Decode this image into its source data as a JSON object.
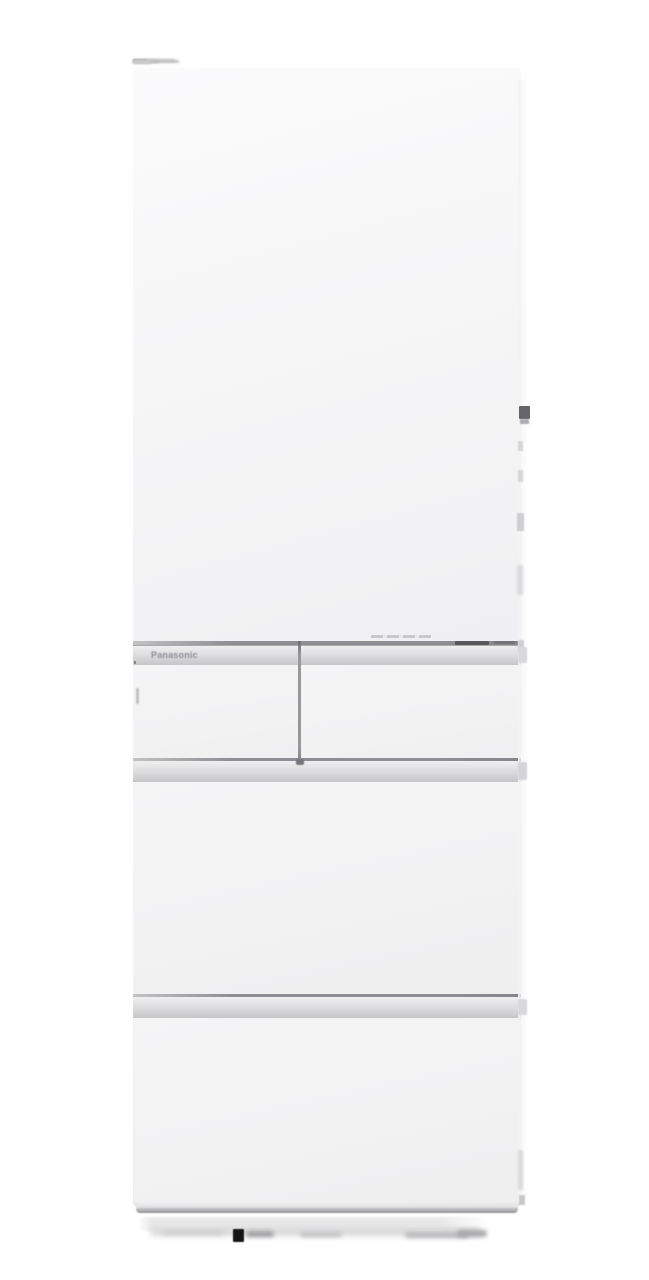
{
  "scene": {
    "subject": "white multi-door refrigerator, front view",
    "background": "plain white studio backdrop"
  },
  "branding": {
    "logo_text": "Panasonic"
  },
  "refrigerator": {
    "door_count_visible": 5,
    "parts": [
      {
        "name": "upper-door"
      },
      {
        "name": "middle-left-door"
      },
      {
        "name": "middle-right-door"
      },
      {
        "name": "middle-drawer"
      },
      {
        "name": "bottom-drawer"
      }
    ],
    "handle_style": "recessed horizontal pull bars"
  },
  "colors": {
    "background": "#ffffff",
    "door_light": "#fbfbfc",
    "door_mid": "#f6f6f7",
    "door_dark": "#f0f0f2",
    "handle_light": "#efeff0",
    "handle_dark": "#c6c6c9",
    "handle_edge": "#a8a8ab",
    "gap_line": "#8f8f93",
    "divider": "#98989b",
    "logo_gray": "#8f8f94",
    "hinge_dark": "#66666a",
    "base_shadow": "#e8e8e9",
    "caster": "#141414"
  }
}
